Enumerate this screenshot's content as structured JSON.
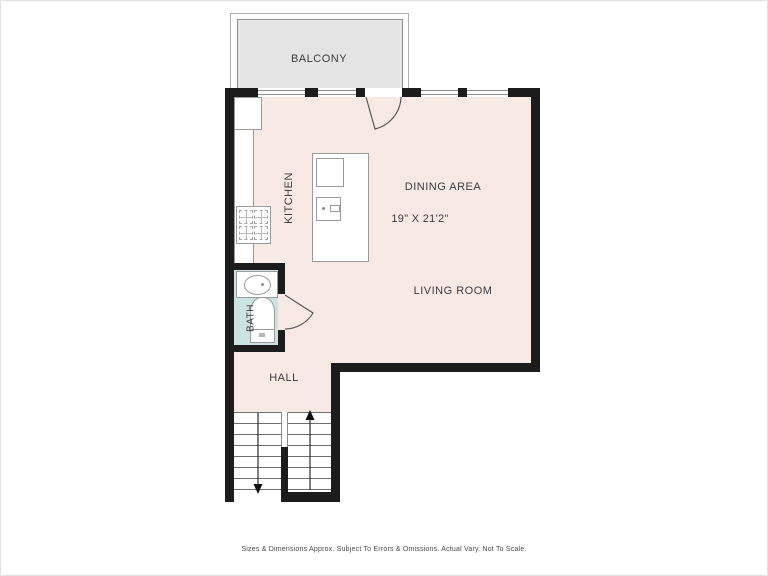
{
  "plan": {
    "labels": {
      "balcony": "BALCONY",
      "kitchen": "KITCHEN",
      "dining": "DINING AREA",
      "dimensions": "19\" X 21'2\"",
      "living": "LIVING ROOM",
      "bath": "BATH",
      "hall": "HALL"
    },
    "colors": {
      "floor": "#f7eae5",
      "bath_floor": "#c9e4e2",
      "balcony": "#e4e4e4",
      "wall": "#1c1c1c",
      "outline": "#9a9a9a",
      "text": "#3c3c3c"
    },
    "icons": {
      "stairs_up": "up-arrow",
      "stairs_down": "down-arrow",
      "door_swing": "quarter-arc"
    }
  },
  "footer": {
    "disclaimer": "Sizes & Dimensions Approx. Subject To Errors & Omissions. Actual Vary. Not To Scale."
  }
}
